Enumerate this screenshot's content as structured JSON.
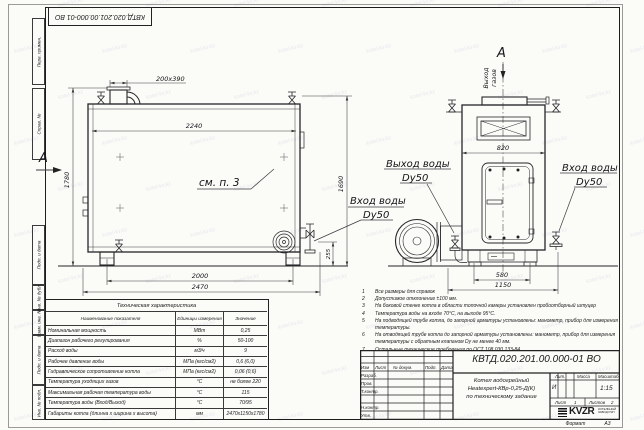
{
  "stamp": {
    "designation": "КВТД.020.201.00.000-01 ВО"
  },
  "margin": {
    "labels": [
      "Перв. примен.",
      "Справ. №",
      "Подп. и дата",
      "Инв. № дубл.",
      "Взам. инв. №",
      "Подп. и дата",
      "Инв. № подл."
    ]
  },
  "left_view": {
    "view_letter": "А",
    "dim_duct": "200х390",
    "dim_top": "2240",
    "dim_h_left": "1780",
    "dim_h_right": "1690",
    "dim_255": "255",
    "dim_2000": "2000",
    "dim_2470": "2470",
    "see_note": "см. п. 3",
    "inlet_l1": "Вход воды",
    "inlet_l2": "Dy50"
  },
  "right_view": {
    "view_letter": "А",
    "gas_l1": "Выход",
    "gas_l2": "газов",
    "dim_820": "820",
    "dim_580": "580",
    "dim_1150": "1150",
    "outlet_l1": "Выход воды",
    "outlet_l2": "Dy50",
    "inlet_l1": "Вход воды",
    "inlet_l2": "Dy50"
  },
  "notes": {
    "items": [
      {
        "n": "1",
        "text": "Все размеры для справок"
      },
      {
        "n": "2",
        "text": "Допустимое отклонение ±100 мм."
      },
      {
        "n": "3",
        "text": "На боковой стенке котла в области топочной камеры установлен пробоотборный штуцер"
      },
      {
        "n": "4",
        "text": "Температура воды на входе 70°С, на выходе 95°С."
      },
      {
        "n": "5",
        "text": "На подводящей трубе котла, до запорной арматуры установлены: манометр, прибор для измерения температуры."
      },
      {
        "n": "6",
        "text": "На отводящей трубе котла до запорной арматуры установлены: манометр, прибор для измерения температуры с обратным клапаном Dy не менее 40 мм."
      },
      {
        "n": "7",
        "text": "Остальные технические требования по ОСТ 108.030.133-84."
      }
    ]
  },
  "table": {
    "title": "Техническая характеристика",
    "headers": [
      "Наименование показателя",
      "Единицы измерения",
      "Значение"
    ],
    "rows": [
      [
        "Номинальная мощность",
        "МВт",
        "0,25"
      ],
      [
        "Диапазон рабочего регулирования",
        "%",
        "50-100"
      ],
      [
        "Расход воды",
        "м3/ч",
        "9"
      ],
      [
        "Рабочее давление воды",
        "МПа (кгс/см2)",
        "0,6 (6,0)"
      ],
      [
        "Гидравлическое сопротивление котла",
        "МПа (кгс/см2)",
        "0,06 (0,6)"
      ],
      [
        "Температура уходящих газов",
        "°С",
        "не более 220"
      ],
      [
        "Максимальная рабочая температура воды",
        "°С",
        "115"
      ],
      [
        "Температура воды (Вход/Выход)",
        "°С",
        "70/95"
      ],
      [
        "Габариты котла (длинна х ширина х высота)",
        "мм",
        "2470х1150х1780"
      ]
    ]
  },
  "title_block": {
    "designation": "КВТД.020.201.00.000-01 ВО",
    "product_l1": "Котел водогрейный",
    "product_l2": "Heatexpert-КВр-0,25-Д(К)",
    "product_l3": "по техническому задание",
    "col_izm": "Изм",
    "col_list": "Лист",
    "col_doc": "№ докум.",
    "col_podp": "Подп.",
    "col_data": "Дата",
    "row_razrab": "Разраб.",
    "row_prov": "Пров.",
    "row_tkontr": "Т.контр.",
    "row_nkontr": "Н.контр.",
    "row_utv": "Утв.",
    "lit_label": "Лит.",
    "mass_label": "Масса",
    "scale_label": "Масштаб",
    "lit_value": "И",
    "scale_value": "1:15",
    "sheet_label": "Лист",
    "sheet_value": "1",
    "sheets_label": "Листов",
    "sheets_value": "2",
    "logo_text": "KVZR",
    "logo_sub1": "КОТЕЛЬНЫЙ",
    "logo_sub2": "ЗАВОД РЭП",
    "format_label": "Формат",
    "format_value": "А3"
  },
  "watermark": {
    "text": "kotel-kv.kz"
  }
}
